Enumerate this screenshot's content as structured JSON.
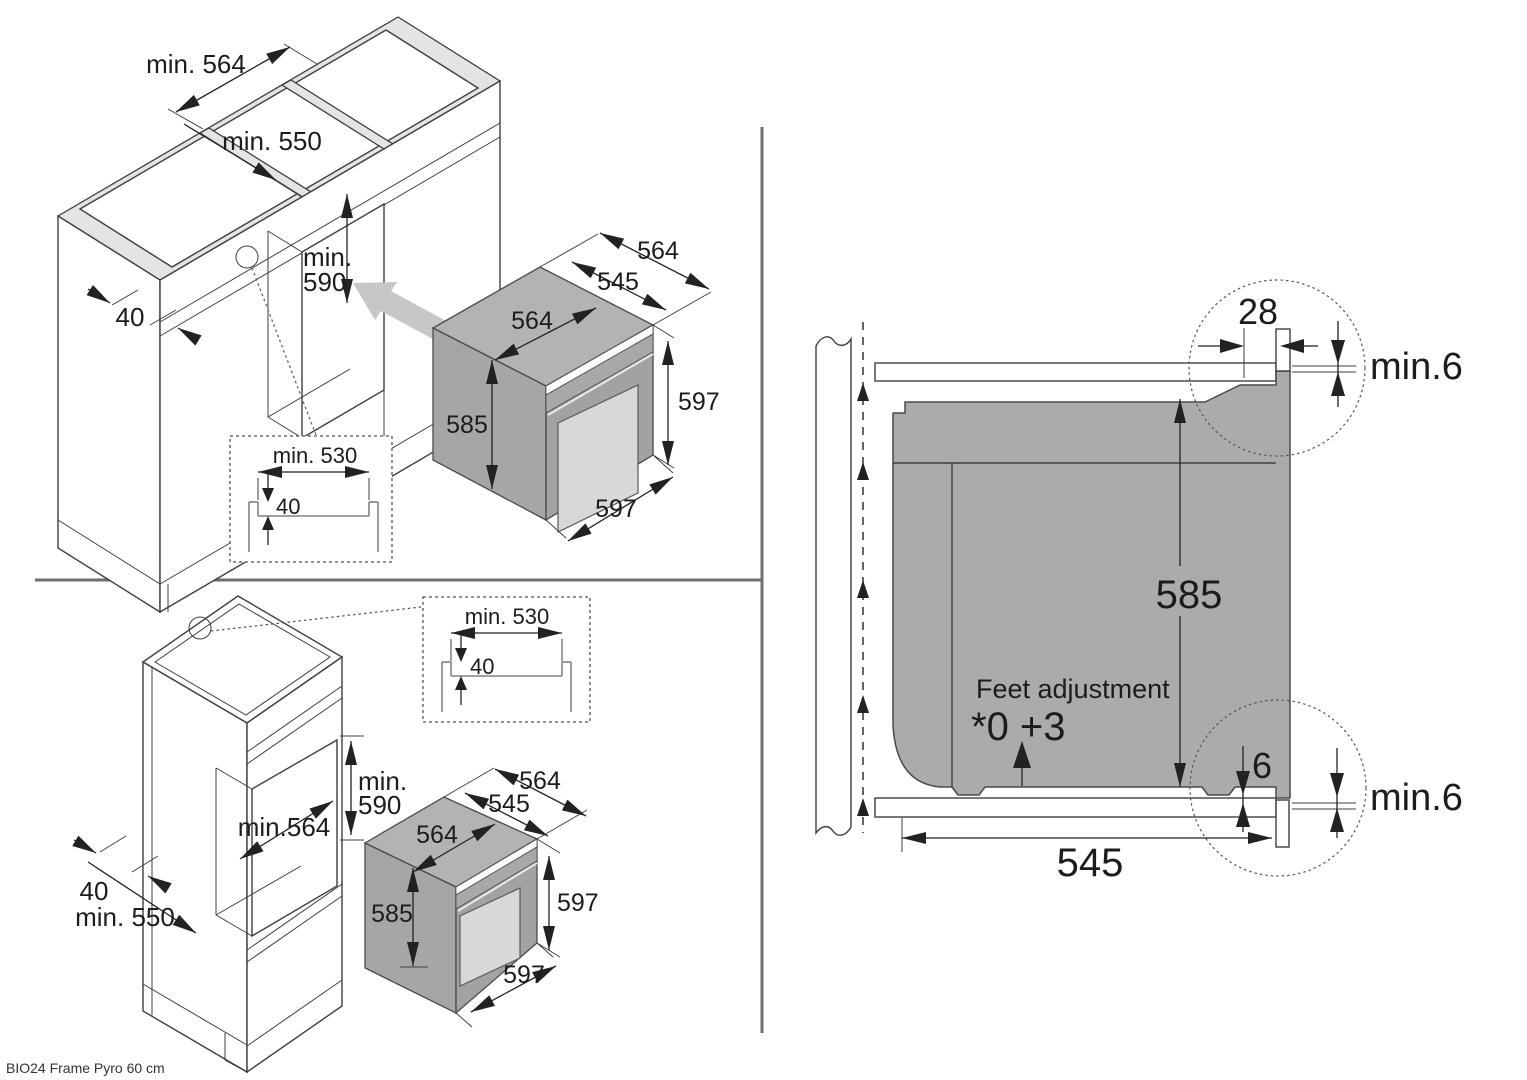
{
  "footer": {
    "model_label": "BIO24 Frame Pyro 60 cm"
  },
  "colors": {
    "line": "#3f3f3f",
    "oven_gray": "#a8a8a8",
    "oven_top_gray": "#b3b3b3",
    "window_gray": "#d8d8d8",
    "frame_light": "#e4e4e4",
    "arrow_gray": "#c7c7c7",
    "section_oven_gray": "#ababab",
    "text": "#1c1c1c"
  },
  "base_cabinet": {
    "niche_width": "min. 564",
    "niche_depth": "min. 550",
    "niche_height_line1": "min.",
    "niche_height_line2": "590",
    "plinth_offset": "40",
    "inset": {
      "width": "min. 530",
      "recess": "40"
    },
    "oven": {
      "depth_total": "564",
      "depth_body": "545",
      "width_top": "564",
      "height_body": "585",
      "height_front": "597",
      "width_front": "597"
    }
  },
  "tall_cabinet": {
    "inset": {
      "width": "min. 530",
      "recess": "40"
    },
    "niche_height_line1": "min.",
    "niche_height_line2": "590",
    "niche_width": "min.564",
    "side_offset": "40",
    "niche_depth": "min. 550",
    "oven": {
      "depth_total": "564",
      "depth_body": "545",
      "width_top": "564",
      "height_body": "585",
      "height_front": "597",
      "width_front": "597"
    }
  },
  "side_section": {
    "top_overhang": "28",
    "top_gap": "min.6",
    "oven_height": "585",
    "feet_label": "Feet adjustment",
    "feet_values": "*0 +3",
    "bottom_gap": "6",
    "bottom_gap_min": "min.6",
    "oven_depth": "545"
  }
}
